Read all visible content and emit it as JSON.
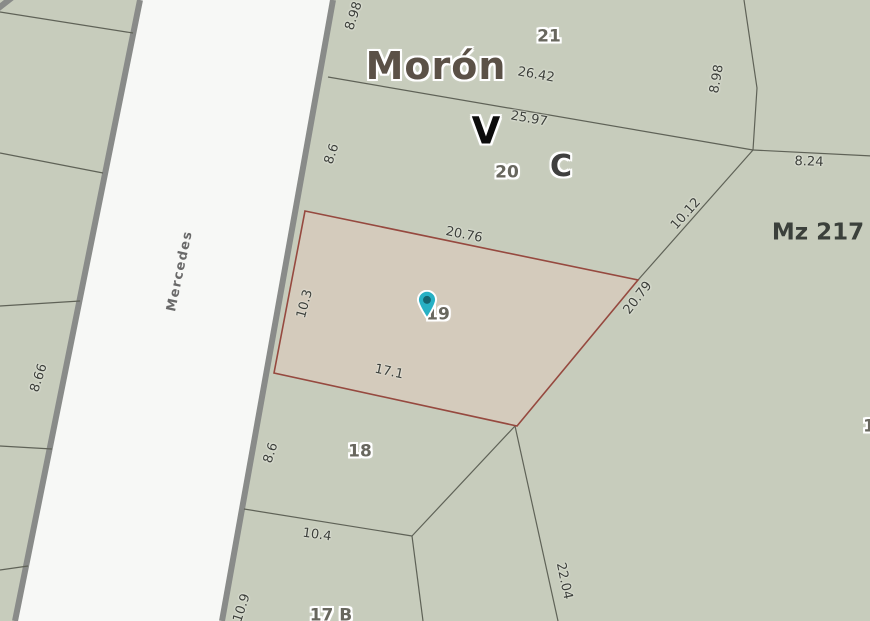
{
  "labels": {
    "city": "Morón",
    "block": "Mz 217",
    "zone_v": "V",
    "zone_c": "C",
    "street": "Mercedes",
    "parcel_21": "21",
    "parcel_20": "20",
    "parcel_19": "19",
    "parcel_18": "18",
    "parcel_17b": "17 B",
    "parcel_edge_right": "1"
  },
  "measurements": {
    "top_left_898": "8.98",
    "frontage_2642": "26.42",
    "frontage_2597": "25.97",
    "upper_86": "8.6",
    "right_898": "8.98",
    "right_824": "8.24",
    "diag_1012": "10.12",
    "sel_top_2076": "20.76",
    "sel_left_103": "10.3",
    "sel_right_2079": "20.79",
    "sel_bottom_171": "17.1",
    "left_866": "8.66",
    "lower_86": "8.6",
    "lower_104": "10.4",
    "bottom_109": "10.9",
    "diag_2204": "22.04"
  },
  "colors": {
    "sage": "#c7ccbc",
    "road-fill": "#f7f8f6",
    "road-edge": "#898b89",
    "boundary": "#5f6257",
    "parcel-fill": "#d4cbbc",
    "parcel-stroke": "#96493f",
    "pin-fill": "#27b0c4",
    "pin-dot": "#156470",
    "text-dark": "#3c3f3a",
    "text-parcel": "#68675e",
    "text-city": "#5b5147",
    "text-street": "#696969"
  }
}
